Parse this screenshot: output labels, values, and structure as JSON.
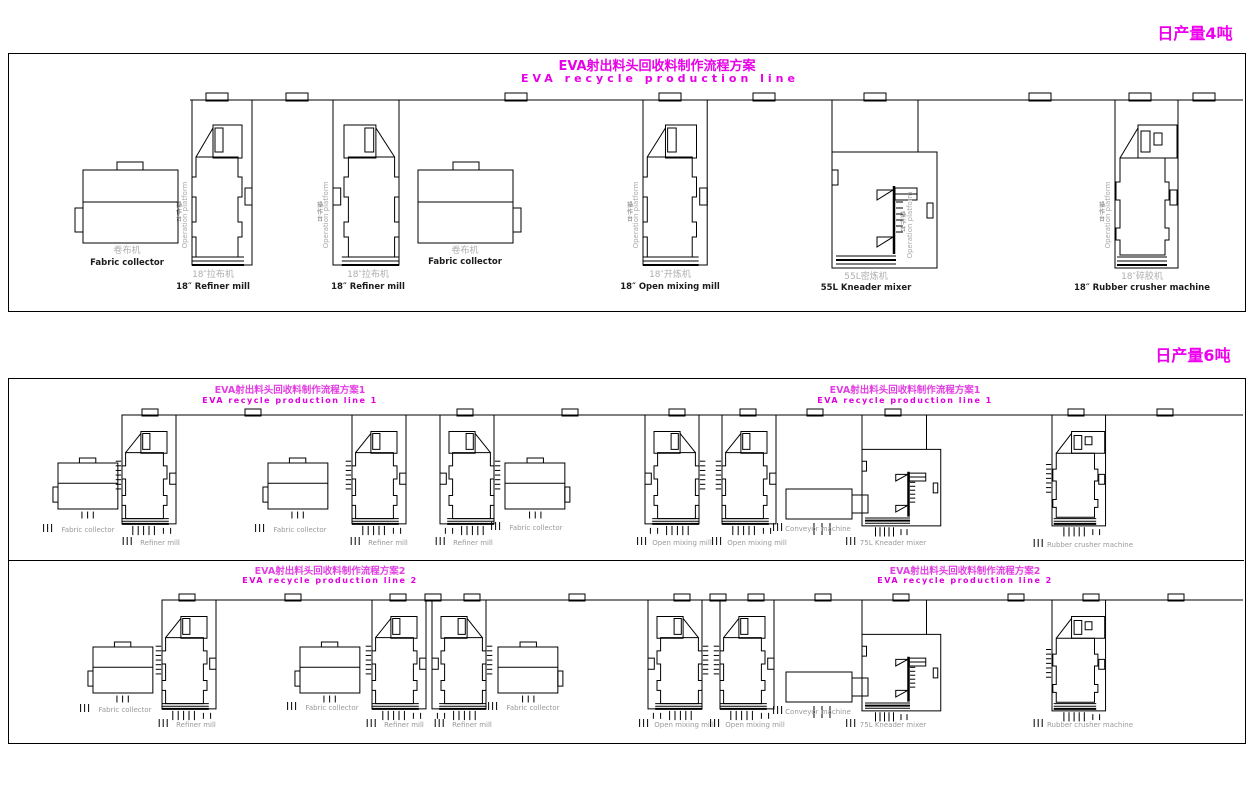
{
  "colors": {
    "line": "#000000",
    "magenta": "#ee00ee",
    "gray_label": "#9a9a9a",
    "dark_label": "#1c1c1c"
  },
  "shared": {
    "platform_zh": "操作台",
    "platform_en": "Operation platform"
  },
  "section1": {
    "tag": "日产量4吨",
    "panel": {
      "x": 8,
      "y": 53,
      "w": 1236,
      "h": 257
    },
    "title_zh": "EVA射出料头回收料制作流程方案",
    "title_en": "EVA recycle production line",
    "wall": {
      "y": 100,
      "x1": 190,
      "x2": 1243,
      "vents": [
        217,
        297,
        516,
        670,
        764,
        875,
        1040,
        1140,
        1204
      ]
    },
    "machines": [
      {
        "type": "fabric_collector",
        "x": 83,
        "y": 162,
        "sx": 1,
        "sy": 1,
        "mirror": false,
        "platform": false,
        "legs": false,
        "zh": "卷布机",
        "en": "Fabric collector",
        "lx": 127,
        "lzy": 253,
        "ley": 265
      },
      {
        "type": "mill",
        "x": 192,
        "y": 100,
        "sx": 1,
        "sy": 1,
        "mirror": false,
        "platform": true,
        "legs": false,
        "zh": "18″拉布机",
        "en": "18″ Refiner mill",
        "lx": 213,
        "lzy": 277,
        "ley": 289
      },
      {
        "type": "mill",
        "x": 333,
        "y": 100,
        "sx": 1.1,
        "sy": 1,
        "mirror": true,
        "platform": true,
        "legs": false,
        "zh": "18″拉布机",
        "en": "18″ Refiner mill",
        "lx": 368,
        "lzy": 277,
        "ley": 289
      },
      {
        "type": "fabric_collector",
        "x": 418,
        "y": 162,
        "sx": 1,
        "sy": 1,
        "mirror": true,
        "platform": false,
        "legs": false,
        "zh": "卷布机",
        "en": "Fabric collector",
        "lx": 465,
        "lzy": 253,
        "ley": 264
      },
      {
        "type": "mill",
        "x": 643,
        "y": 100,
        "sx": 1.07,
        "sy": 1,
        "mirror": false,
        "platform": true,
        "legs": false,
        "zh": "18″开炼机",
        "en": "18″ Open mixing mill",
        "lx": 670,
        "lzy": 277,
        "ley": 289
      },
      {
        "type": "kneader",
        "x": 832,
        "y": 100,
        "sx": 1,
        "sy": 1,
        "mirror": false,
        "platform": true,
        "legs": false,
        "zh": "55L密炼机",
        "en": "55L Kneader mixer",
        "lx": 866,
        "lzy": 279,
        "ley": 290
      },
      {
        "type": "crusher",
        "x": 1115,
        "y": 100,
        "sx": 1,
        "sy": 1,
        "mirror": false,
        "platform": true,
        "legs": false,
        "zh": "18″碎胶机",
        "en": "18″ Rubber crusher machine",
        "lx": 1142,
        "lzy": 279,
        "ley": 290
      }
    ]
  },
  "section2": {
    "tag": "日产量6吨",
    "panel": {
      "x": 8,
      "y": 378,
      "w": 1236,
      "h": 364
    },
    "divider_y": 560,
    "lines": [
      {
        "title_zh": "EVA射出料头回收料制作流程方案1",
        "title_en": "EVA recycle production line 1",
        "wall": {
          "y": 415,
          "x1": 133,
          "x2": 1243,
          "vents": [
            150,
            253,
            465,
            570,
            677,
            748,
            815,
            893,
            1076,
            1165
          ]
        },
        "machines": [
          {
            "type": "fabric_collector",
            "x": 58,
            "y": 458,
            "sx": 0.63,
            "sy": 0.63,
            "mirror": false,
            "platform": false,
            "legs": true,
            "en": "Fabric collector",
            "lx": 88,
            "ley": 532
          },
          {
            "type": "mill",
            "x": 122,
            "y": 415,
            "sx": 0.9,
            "sy": 0.66,
            "mirror": false,
            "platform": false,
            "legs": true,
            "en": "Refiner mill",
            "lx": 160,
            "ley": 545
          },
          {
            "type": "fabric_collector",
            "x": 268,
            "y": 458,
            "sx": 0.63,
            "sy": 0.63,
            "mirror": false,
            "platform": false,
            "legs": true,
            "en": "Fabric collector",
            "lx": 300,
            "ley": 532
          },
          {
            "type": "mill",
            "x": 352,
            "y": 415,
            "sx": 0.9,
            "sy": 0.66,
            "mirror": false,
            "platform": false,
            "legs": true,
            "en": "Refiner mill",
            "lx": 388,
            "ley": 545
          },
          {
            "type": "mill",
            "x": 440,
            "y": 415,
            "sx": 0.9,
            "sy": 0.66,
            "mirror": true,
            "platform": false,
            "legs": true,
            "en": "Refiner mill",
            "lx": 473,
            "ley": 545
          },
          {
            "type": "fabric_collector",
            "x": 505,
            "y": 458,
            "sx": 0.63,
            "sy": 0.63,
            "mirror": true,
            "platform": false,
            "legs": true,
            "en": "Fabric collector",
            "lx": 536,
            "ley": 530
          },
          {
            "type": "mill",
            "x": 645,
            "y": 415,
            "sx": 0.9,
            "sy": 0.66,
            "mirror": true,
            "platform": false,
            "legs": true,
            "en": "Open mixing mill",
            "lx": 682,
            "ley": 545
          },
          {
            "type": "mill",
            "x": 722,
            "y": 415,
            "sx": 0.9,
            "sy": 0.66,
            "mirror": false,
            "platform": false,
            "legs": true,
            "en": "Open mixing mill",
            "lx": 757,
            "ley": 545
          },
          {
            "type": "conveyor",
            "x": 786,
            "y": 485,
            "sx": 1,
            "sy": 1,
            "mirror": false,
            "platform": false,
            "legs": true,
            "en": "Conveyor machine",
            "lx": 818,
            "ley": 531
          },
          {
            "type": "kneader",
            "x": 862,
            "y": 415,
            "sx": 0.75,
            "sy": 0.66,
            "mirror": false,
            "platform": false,
            "legs": true,
            "en": "75L Kneader mixer",
            "lx": 893,
            "ley": 545
          },
          {
            "type": "crusher",
            "x": 1052,
            "y": 415,
            "sx": 0.85,
            "sy": 0.66,
            "mirror": false,
            "platform": false,
            "legs": true,
            "en": "Rubber crusher machine",
            "lx": 1090,
            "ley": 547
          }
        ]
      },
      {
        "title_zh": "EVA射出料头回收料制作流程方案2",
        "title_en": "EVA recycle production line 2",
        "wall": {
          "y": 600,
          "x1": 170,
          "x2": 1243,
          "vents": [
            187,
            293,
            398,
            433,
            472,
            577,
            682,
            718,
            756,
            823,
            901,
            1016,
            1091,
            1176
          ]
        },
        "machines": [
          {
            "type": "fabric_collector",
            "x": 93,
            "y": 642,
            "sx": 0.63,
            "sy": 0.63,
            "mirror": false,
            "platform": false,
            "legs": true,
            "en": "Fabric collector",
            "lx": 125,
            "ley": 712
          },
          {
            "type": "mill",
            "x": 162,
            "y": 600,
            "sx": 0.9,
            "sy": 0.66,
            "mirror": false,
            "platform": false,
            "legs": true,
            "en": "Refiner mill",
            "lx": 196,
            "ley": 727
          },
          {
            "type": "fabric_collector",
            "x": 300,
            "y": 642,
            "sx": 0.63,
            "sy": 0.63,
            "mirror": false,
            "platform": false,
            "legs": true,
            "en": "Fabric collector",
            "lx": 332,
            "ley": 710
          },
          {
            "type": "mill",
            "x": 372,
            "y": 600,
            "sx": 0.9,
            "sy": 0.66,
            "mirror": false,
            "platform": false,
            "legs": true,
            "en": "Refiner mill",
            "lx": 404,
            "ley": 727
          },
          {
            "type": "mill",
            "x": 432,
            "y": 600,
            "sx": 0.9,
            "sy": 0.66,
            "mirror": true,
            "platform": false,
            "legs": true,
            "en": "Refiner mill",
            "lx": 472,
            "ley": 727
          },
          {
            "type": "fabric_collector",
            "x": 498,
            "y": 642,
            "sx": 0.63,
            "sy": 0.63,
            "mirror": true,
            "platform": false,
            "legs": true,
            "en": "Fabric collector",
            "lx": 533,
            "ley": 710
          },
          {
            "type": "mill",
            "x": 648,
            "y": 600,
            "sx": 0.9,
            "sy": 0.66,
            "mirror": true,
            "platform": false,
            "legs": true,
            "en": "Open mixing mill",
            "lx": 684,
            "ley": 727
          },
          {
            "type": "mill",
            "x": 720,
            "y": 600,
            "sx": 0.9,
            "sy": 0.66,
            "mirror": false,
            "platform": false,
            "legs": true,
            "en": "Open mixing mill",
            "lx": 755,
            "ley": 727
          },
          {
            "type": "conveyor",
            "x": 786,
            "y": 668,
            "sx": 1,
            "sy": 1,
            "mirror": false,
            "platform": false,
            "legs": true,
            "en": "Conveyor machine",
            "lx": 818,
            "ley": 714
          },
          {
            "type": "kneader",
            "x": 862,
            "y": 600,
            "sx": 0.75,
            "sy": 0.66,
            "mirror": false,
            "platform": false,
            "legs": true,
            "en": "75L Kneader mixer",
            "lx": 893,
            "ley": 727
          },
          {
            "type": "crusher",
            "x": 1052,
            "y": 600,
            "sx": 0.85,
            "sy": 0.66,
            "mirror": false,
            "platform": false,
            "legs": true,
            "en": "Rubber crusher machine",
            "lx": 1090,
            "ley": 727
          }
        ]
      }
    ]
  }
}
